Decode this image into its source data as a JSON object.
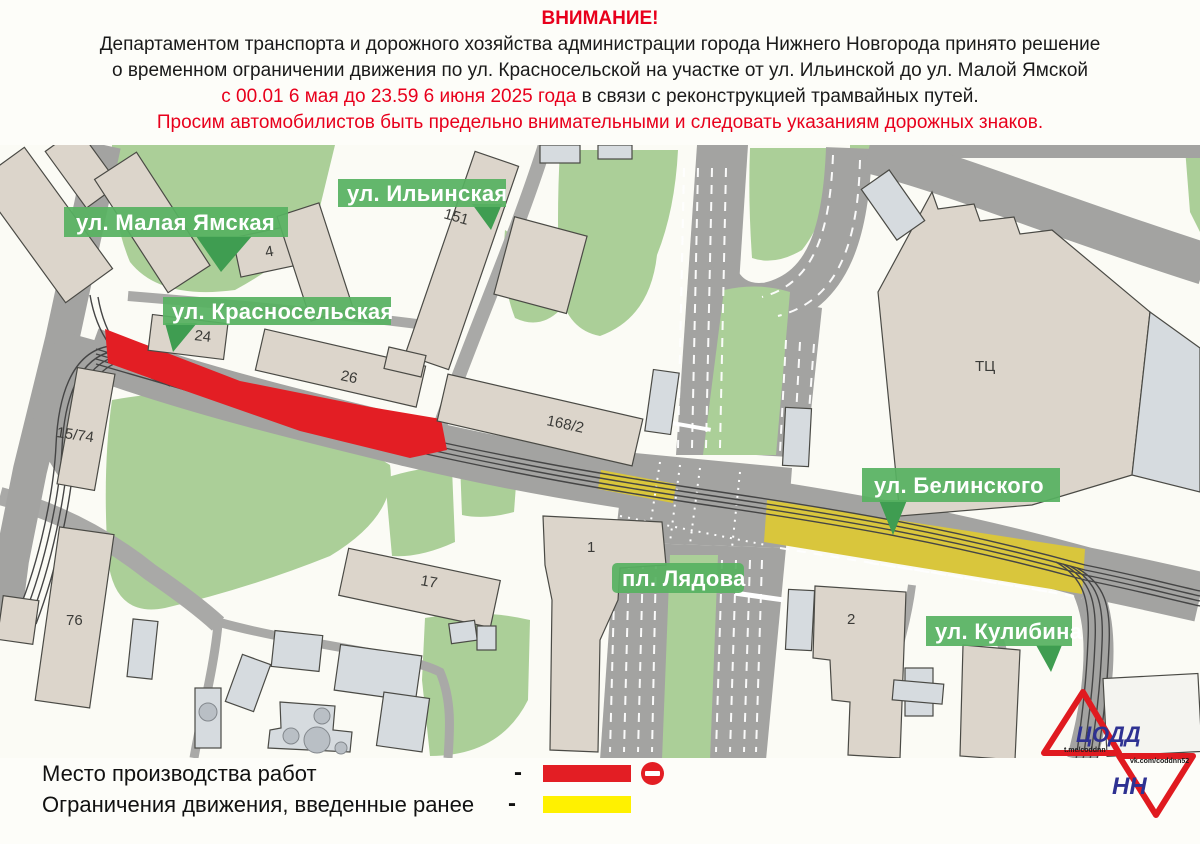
{
  "header": {
    "title": "ВНИМАНИЕ!",
    "line1": "Департаментом транспорта и дорожного хозяйства администрации города Нижнего Новгорода принято решение",
    "line2": "о временном  ограничении движения по ул. Красносельской на участке от ул. Ильинской до ул. Малой Ямской",
    "line3_red": "с 00.01 6 мая до 23.59 6 июня 2025 года",
    "line3_black": " в связи с реконструкцией трамвайных путей.",
    "line4": "Просим автомобилистов быть предельно внимательными и следовать указаниям дорожных знаков."
  },
  "map": {
    "street_labels": [
      {
        "label": "ул. Малая Ямская"
      },
      {
        "label": "ул. Ильинская"
      },
      {
        "label": "ул. Красносельская"
      },
      {
        "label": "ул. Белинского"
      },
      {
        "label": "пл. Лядова"
      },
      {
        "label": "ул. Кулибина"
      }
    ],
    "building_numbers": [
      "151",
      "4",
      "24",
      "26",
      "15/74",
      "168/2",
      "76",
      "17",
      "1",
      "2",
      "ТЦ"
    ]
  },
  "legend": {
    "items": [
      {
        "label": "Место производства работ",
        "dash": "-",
        "color": "#e31e24",
        "icon": "no-entry-icon"
      },
      {
        "label": "Ограничения движения, введенные ранее",
        "dash": "-",
        "color": "#fff100"
      }
    ]
  },
  "logo": {
    "org": "ЦОДД",
    "city": "НН",
    "telegram": "t.me/coddnn",
    "vk": "vk.com/coddnn52"
  },
  "colors": {
    "accent_red": "#e31e24",
    "restriction_yellow": "#d9c63c",
    "legend_yellow": "#fff100",
    "label_green": "#57b261",
    "label_pointer_green": "#3f9d51",
    "road_gray": "#a3a3a1",
    "park_green": "#abcf98",
    "building_beige": "#dcd5cb",
    "building_blue": "#d6dbdf",
    "logo_red": "#e01a20",
    "logo_blue": "#2e3192"
  }
}
